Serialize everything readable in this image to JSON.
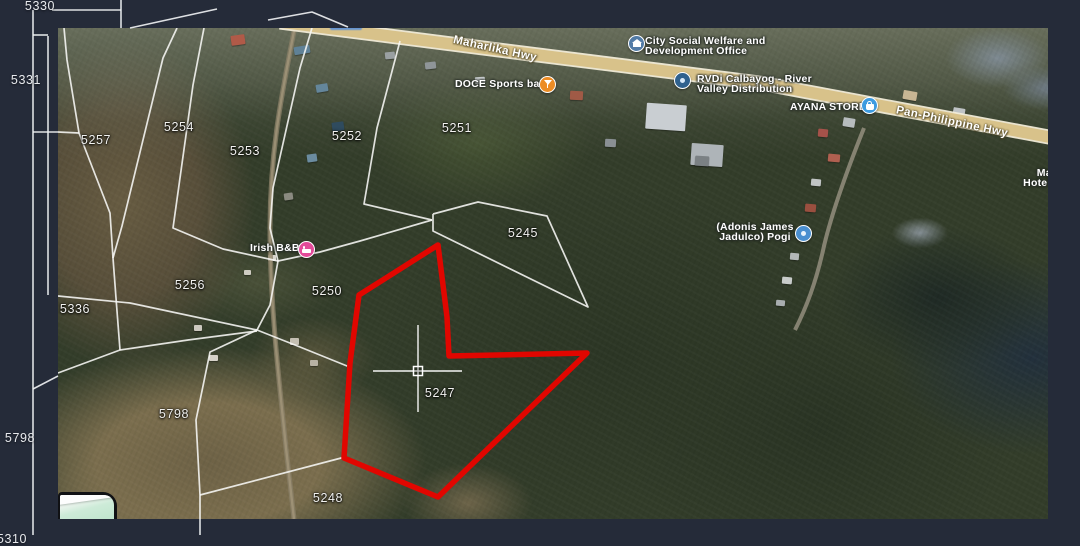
{
  "window": {
    "background": "#252b39"
  },
  "viewport": {
    "x": 58,
    "y": 28,
    "width": 990,
    "height": 491
  },
  "selection": {
    "color": "#e10600",
    "stroke_width": 5.5,
    "points": "380,217 389,289 391,328 529,325 380,469 286,430 292,335 301,267"
  },
  "crosshair": {
    "color": "#ffffff",
    "cx": 360,
    "cy": 343,
    "h1": 315,
    "h2": 404,
    "v1": 297,
    "v2": 384,
    "box": 9
  },
  "parcel_labels": [
    {
      "text": "5254",
      "x": 121,
      "y": 99
    },
    {
      "text": "5253",
      "x": 187,
      "y": 123
    },
    {
      "text": "5252",
      "x": 289,
      "y": 108
    },
    {
      "text": "5251",
      "x": 399,
      "y": 100
    },
    {
      "text": "5245",
      "x": 465,
      "y": 205
    },
    {
      "text": "5257",
      "x": 38,
      "y": 112
    },
    {
      "text": "5256",
      "x": 132,
      "y": 257
    },
    {
      "text": "5250",
      "x": 269,
      "y": 263
    },
    {
      "text": "5336",
      "x": 17,
      "y": 281
    },
    {
      "text": "5247",
      "x": 382,
      "y": 365
    },
    {
      "text": "5798",
      "x": 116,
      "y": 386
    },
    {
      "text": "5248",
      "x": 270,
      "y": 470
    }
  ],
  "margin_labels": [
    {
      "text": "5330",
      "x": 40,
      "y": 6
    },
    {
      "text": "5331",
      "x": 26,
      "y": 80
    },
    {
      "text": "5798",
      "x": 20,
      "y": 438
    },
    {
      "text": "5310",
      "x": 12,
      "y": 539
    }
  ],
  "white_lines": [
    "119,0 105,30 64,198 55,230 58,270 62,322",
    "6,0 9,32 21,105 52,185 55,230",
    "0,104 21,105",
    "146,0 135,57 115,200 165,221 220,233",
    "254,0 242,40 215,160 212,200 220,233",
    "220,233 262,224 302,213 374,192",
    "342,13 319,100 306,176 374,192",
    "220,233 212,277 199,302",
    "0,268 72,275 199,302",
    "199,302 242,319 294,340",
    "199,302 152,324 138,392 142,467 142,491",
    "142,467 287,429",
    "0,345 62,322 130,312 199,303",
    "375,186 420,174 489,188 530,279 375,203 375,186"
  ],
  "margin_lines": [
    "33,10 33,535",
    "48,36 48,295",
    "33,35 48,35",
    "52,10 121,10",
    "121,0 121,28",
    "33,132 58,132",
    "33,389 58,376",
    "200,519 200,535",
    "130,28 217,9",
    "268,20 312,12 348,27"
  ],
  "roads": {
    "highway_path": "M222,-6 L472,26 L702,55 L996,110",
    "highway_fill": "#d8c28a",
    "highway_casing": "#f2ecd8",
    "village_left_path": "M237,-2 C225,60 212,120 212,200 C212,280 222,360 228,420 C232,455 234,475 236,491",
    "village_right_path": "M806,100 C792,135 775,180 766,218 C758,255 748,280 737,302",
    "labels": [
      {
        "text": "Maharlika Hwy",
        "x": 437,
        "y": 21,
        "angle": 12.5
      },
      {
        "text": "Pan-Philippine Hwy",
        "x": 894,
        "y": 94,
        "angle": 12
      }
    ]
  },
  "pois": [
    {
      "id": "city-social-welfare-office",
      "lines": [
        "City Social Welfare and",
        "Development Office"
      ],
      "lx": 587,
      "ly": 8,
      "align": "left",
      "icon": {
        "x": 578,
        "y": 15,
        "color": "#527ba6",
        "glyph": "bank"
      }
    },
    {
      "id": "doce-sports-bar",
      "lines": [
        "DOCE Sports bar"
      ],
      "lx": 397,
      "ly": 51,
      "align": "left",
      "icon": {
        "x": 489,
        "y": 56,
        "color": "#ec8c25",
        "glyph": "drink"
      }
    },
    {
      "id": "rvdi-calbayog",
      "lines": [
        "RVDi Calbayog - River",
        "Valley Distribution"
      ],
      "lx": 639,
      "ly": 46,
      "align": "left",
      "icon": {
        "x": 624,
        "y": 52,
        "color": "#2f618e",
        "glyph": "dot"
      }
    },
    {
      "id": "ayana-store",
      "lines": [
        "AYANA STORE"
      ],
      "lx": 732,
      "ly": 74,
      "align": "left",
      "icon": {
        "x": 811,
        "y": 77,
        "color": "#3d9be0",
        "glyph": "bag"
      }
    },
    {
      "id": "irish-bnb",
      "lines": [
        "Irish B&B"
      ],
      "lx": 192,
      "ly": 215,
      "align": "left",
      "icon": {
        "x": 248,
        "y": 221,
        "color": "#e24a99",
        "glyph": "bed"
      }
    },
    {
      "id": "adonis-james-jadulco-pogi",
      "lines": [
        "(Adonis James",
        "Jadulco) Pogi"
      ],
      "lx": 652,
      "ly": 194,
      "align": "center",
      "width": 90,
      "icon": {
        "x": 745,
        "y": 205,
        "color": "#4a8fd0",
        "glyph": "dot"
      }
    },
    {
      "id": "hotel-label-partial",
      "lines": [
        "Marj",
        "Hotel and"
      ],
      "lx": 947,
      "ly": 140,
      "align": "center",
      "width": 86,
      "icon": null
    }
  ],
  "buildings": [
    [
      173,
      7,
      14,
      10,
      -8,
      "#b05a48"
    ],
    [
      236,
      18,
      16,
      8,
      -10,
      "#5f8196"
    ],
    [
      258,
      56,
      12,
      8,
      -10,
      "#64869b"
    ],
    [
      274,
      94,
      12,
      9,
      -8,
      "#2f4b5e"
    ],
    [
      249,
      126,
      10,
      8,
      -8,
      "#6b8ca0"
    ],
    [
      226,
      165,
      9,
      7,
      -8,
      "#8a8a80"
    ],
    [
      327,
      24,
      10,
      7,
      -6,
      "#9aa0a2"
    ],
    [
      367,
      34,
      11,
      7,
      -6,
      "#8f9598"
    ],
    [
      417,
      49,
      10,
      7,
      -4,
      "#c7cbcd"
    ],
    [
      512,
      63,
      13,
      9,
      3,
      "#a05a46"
    ],
    [
      547,
      111,
      11,
      8,
      3,
      "#8a9094"
    ],
    [
      588,
      76,
      40,
      26,
      4,
      "#c9ced2"
    ],
    [
      633,
      116,
      32,
      22,
      4,
      "#aeb4b8"
    ],
    [
      637,
      128,
      14,
      10,
      4,
      "#7b8184"
    ],
    [
      845,
      63,
      14,
      9,
      10,
      "#c8b694"
    ],
    [
      895,
      80,
      12,
      8,
      10,
      "#bfc3c5"
    ],
    [
      785,
      90,
      12,
      9,
      10,
      "#b7bcbe"
    ],
    [
      760,
      101,
      10,
      8,
      5,
      "#a5524a"
    ],
    [
      770,
      126,
      12,
      8,
      5,
      "#b06050"
    ],
    [
      753,
      151,
      10,
      7,
      5,
      "#c0c4c4"
    ],
    [
      747,
      176,
      11,
      8,
      5,
      "#9a4f3f"
    ],
    [
      738,
      201,
      10,
      7,
      5,
      "#cfd2d0"
    ],
    [
      732,
      225,
      9,
      7,
      5,
      "#b3b8b8"
    ],
    [
      724,
      249,
      10,
      7,
      5,
      "#c8ccca"
    ],
    [
      718,
      272,
      9,
      6,
      5,
      "#a8adaf"
    ],
    [
      210,
      227,
      8,
      6,
      0,
      "#d8d5cc"
    ],
    [
      186,
      242,
      7,
      5,
      0,
      "#cfccc2"
    ],
    [
      136,
      297,
      8,
      6,
      0,
      "#ccc8bf"
    ],
    [
      151,
      327,
      9,
      6,
      0,
      "#d6d2c8"
    ],
    [
      232,
      310,
      9,
      7,
      0,
      "#c4bfb2"
    ],
    [
      252,
      332,
      8,
      6,
      0,
      "#b8b2a4"
    ]
  ],
  "partial_blue_label": {
    "x": 272,
    "y": -4,
    "w": 32,
    "h": 6
  },
  "minimap": {
    "x": 0,
    "y": 464,
    "w": 59,
    "h": 27
  },
  "line_style": {
    "parcel_color": "#f8f8f6",
    "parcel_width": 1.7
  }
}
